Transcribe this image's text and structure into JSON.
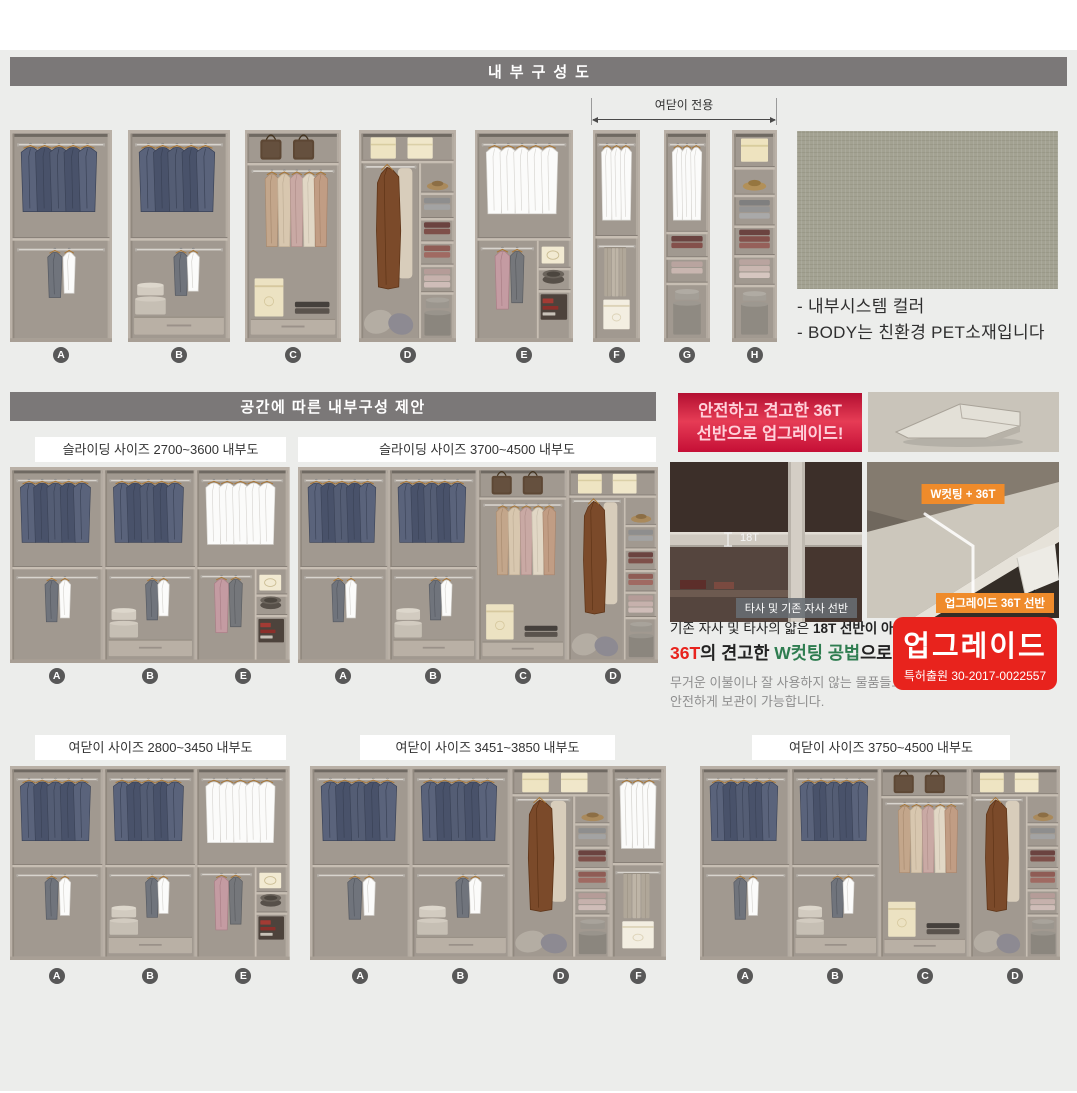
{
  "colors": {
    "content_bg": "#ecedeb",
    "header_bar": "#7b7878",
    "accent_red": "#e8231d",
    "promo_red": "#c50f36",
    "orange": "#ef8b2b",
    "green": "#2e7d50",
    "swatch_green_gray": "#a3a292",
    "letter_badge": "#585858"
  },
  "section_internal": {
    "title": "내부구성도",
    "bracket_label": "여닫이 전용",
    "units": [
      {
        "letter": "A",
        "type": "A"
      },
      {
        "letter": "B",
        "type": "B"
      },
      {
        "letter": "C",
        "type": "C"
      },
      {
        "letter": "D",
        "type": "D"
      },
      {
        "letter": "E",
        "type": "E"
      },
      {
        "letter": "F",
        "type": "F"
      },
      {
        "letter": "G",
        "type": "G"
      },
      {
        "letter": "H",
        "type": "H"
      }
    ],
    "notes": [
      "- 내부시스템 컬러",
      "- BODY는 친환경 PET소재입니다"
    ]
  },
  "section_suggest": {
    "title": "공간에 따른 내부구성 제안",
    "diagrams": [
      {
        "id": "sliding-2700-3600",
        "label": "슬라이딩 사이즈 2700~3600 내부도",
        "modules": [
          "A",
          "B",
          "E"
        ]
      },
      {
        "id": "sliding-3700-4500",
        "label": "슬라이딩 사이즈 3700~4500 내부도",
        "modules": [
          "A",
          "B",
          "C",
          "D"
        ]
      },
      {
        "id": "hinged-2800-3450",
        "label": "여닫이 사이즈 2800~3450 내부도",
        "modules": [
          "A",
          "B",
          "E"
        ]
      },
      {
        "id": "hinged-3451-3850",
        "label": "여닫이 사이즈 3451~3850 내부도",
        "modules": [
          "A",
          "B",
          "D",
          "F"
        ]
      },
      {
        "id": "hinged-3750-4500",
        "label": "여닫이 사이즈 3750~4500 내부도",
        "modules": [
          "A",
          "B",
          "C",
          "D"
        ]
      }
    ]
  },
  "promo": {
    "headline": [
      "안전하고 견고한 36T",
      "선반으로 업그레이드!"
    ],
    "old_shelf_tag": "18T",
    "old_shelf_caption": "타사 및 기존 자사 선반",
    "new_shelf_tag": "W컷팅 + 36T",
    "new_shelf_caption": "업그레이드 36T 선반",
    "desc_line1": [
      {
        "t": "기존 자사 및 타사의 얇은 "
      },
      {
        "t": "18T 선반이 아닌",
        "bold": true
      }
    ],
    "desc_line2": [
      {
        "t": "36T",
        "color": "#e8231d"
      },
      {
        "t": "의 견고한 ",
        "color": "#222222"
      },
      {
        "t": "W컷팅 공법",
        "color": "#2e7d50"
      },
      {
        "t": "으로",
        "color": "#222222"
      }
    ],
    "desc_body": [
      "무거운 이불이나 잘 사용하지 않는 물품들도",
      "안전하게 보관이 가능합니다."
    ],
    "patent_badge": {
      "title": "업그레이드",
      "sub": "특허출원 30-2017-0022557"
    }
  }
}
